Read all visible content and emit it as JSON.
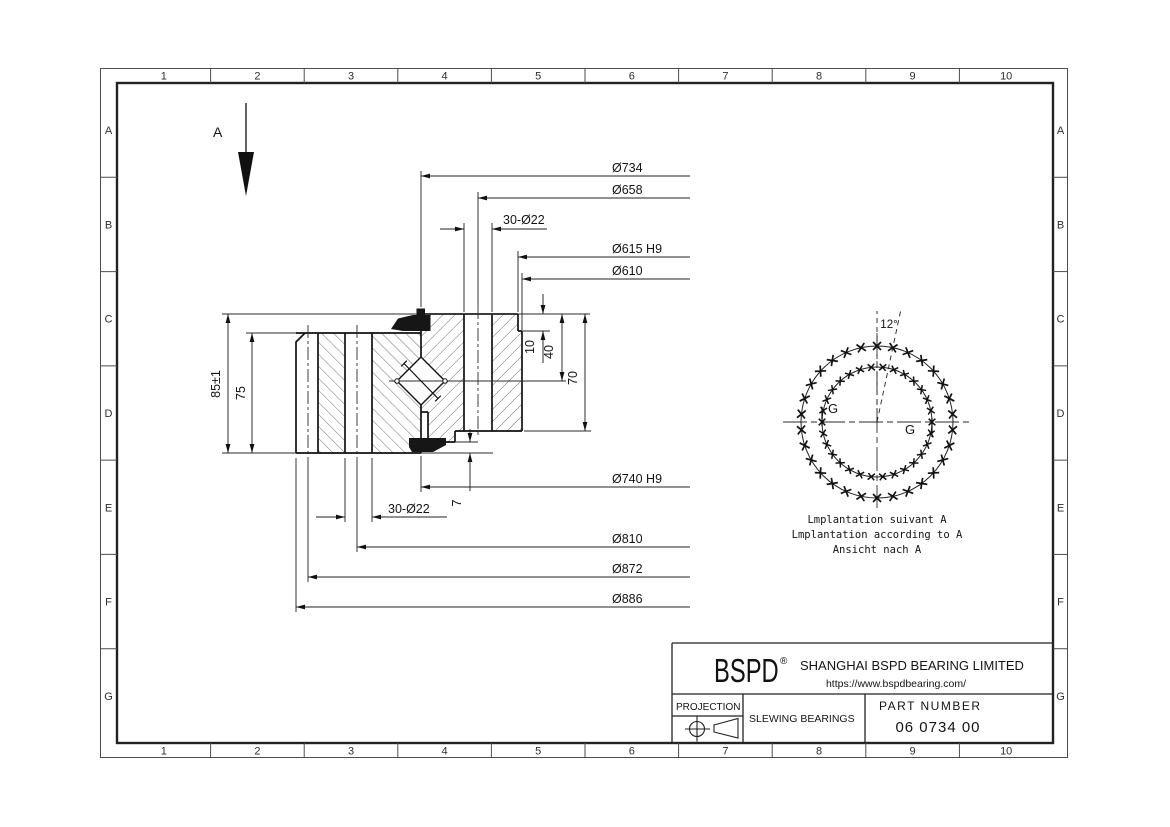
{
  "frame": {
    "columns": [
      "1",
      "2",
      "3",
      "4",
      "5",
      "6",
      "7",
      "8",
      "9",
      "10"
    ],
    "rows": [
      "A",
      "B",
      "C",
      "D",
      "E",
      "F",
      "G"
    ]
  },
  "section_view": {
    "view_arrow_label": "A",
    "dims_top": [
      "Ø734",
      "Ø658",
      "30-Ø22",
      "Ø615 H9",
      "Ø610"
    ],
    "dims_bottom": [
      "Ø740 H9",
      "30-Ø22",
      "Ø810",
      "Ø872",
      "Ø886"
    ],
    "dims_left": [
      "85±1",
      "75"
    ],
    "dims_right": [
      "10",
      "40",
      "70",
      "7"
    ]
  },
  "bolt_view": {
    "angle_label": "12°",
    "grease_label_left": "G",
    "grease_label_right": "G",
    "holes_outer": 30,
    "holes_inner": 30,
    "hole_spacing_deg": 12,
    "caption": [
      "Lmplantation suivant A",
      "Lmplantation according to A",
      "Ansicht nach A"
    ]
  },
  "title_block": {
    "logo": "BSPD",
    "registered": "®",
    "company": "SHANGHAI BSPD BEARING LIMITED",
    "website": "https://www.bspdbearing.com/",
    "projection_label": "PROJECTION",
    "product": "SLEWING BEARINGS",
    "part_number_label": "PART NUMBER",
    "part_number": "06 0734 00"
  }
}
